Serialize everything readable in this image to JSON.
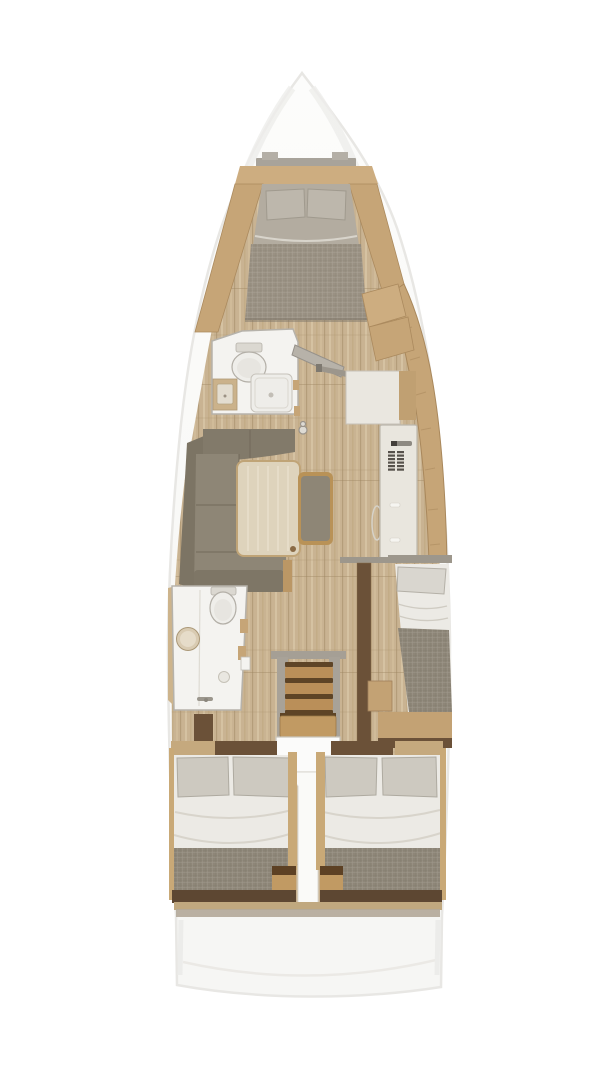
{
  "meta": {
    "title": "Sailing yacht interior layout — top-down floor plan rendering",
    "view": "overhead",
    "text_on_image": "none"
  },
  "colors": {
    "background": "#ffffff",
    "hull_edge": "#e8e7e4",
    "deck_grey": "#a8a39a",
    "deck_grey_light": "#b4afa6",
    "wood_floor": "#c9b392",
    "wood_trim": "#cdad80",
    "wood_counter": "#c6a577",
    "wood_table": "#ded3bc",
    "wood_step": "#ba8f59",
    "wood_step_dark": "#5e4426",
    "wood_dark": "#6b5138",
    "wood_rail": "#c9a977",
    "sofa": "#8e8676",
    "sofa_dark": "#7e7666",
    "sofa_back": "#827a6a",
    "bed_duvet": "#b3aca0",
    "bed_foot": "#9a9183",
    "pillow_grey": "#cdc9c0",
    "pillow_fwd": "#bdb7ac",
    "sheet_white": "#eceae5",
    "blanket_taupe": "#8e8678",
    "bath_white": "#f4f3f0",
    "fixture_white": "#efeeea",
    "fixture_edge": "#b3afa7",
    "cabinet_white": "#eae7e0",
    "fridge_white": "#e9e6de",
    "vent_dark": "#56514b",
    "grey_trim": "#9d978c",
    "rail_grey": "#a8a298",
    "landing_white": "#fbfbfa",
    "transom_brown": "#5d4732",
    "transom_tan": "#c0a87f",
    "transom_grey": "#b2a999",
    "sink_tan": "#d9cbb2"
  },
  "regions": [
    {
      "id": "forward-cabin",
      "label": "forward cabin with double V-berth"
    },
    {
      "id": "forward-head",
      "label": "forward bathroom with toilet, sink and shower"
    },
    {
      "id": "saloon",
      "label": "saloon with L-shaped sofa, table and bench"
    },
    {
      "id": "galley",
      "label": "starboard cabinet area with worktop and fridge unit"
    },
    {
      "id": "aft-head",
      "label": "aft bathroom with toilet, sink and shower"
    },
    {
      "id": "companionway",
      "label": "companionway steps with landing"
    },
    {
      "id": "starboard-mid-berth",
      "label": "starboard aft cabin berth head"
    },
    {
      "id": "port-aft-cabin",
      "label": "port aft double berth"
    },
    {
      "id": "starboard-aft-cabin",
      "label": "starboard aft double berth"
    },
    {
      "id": "stern",
      "label": "stern transom platform"
    }
  ]
}
